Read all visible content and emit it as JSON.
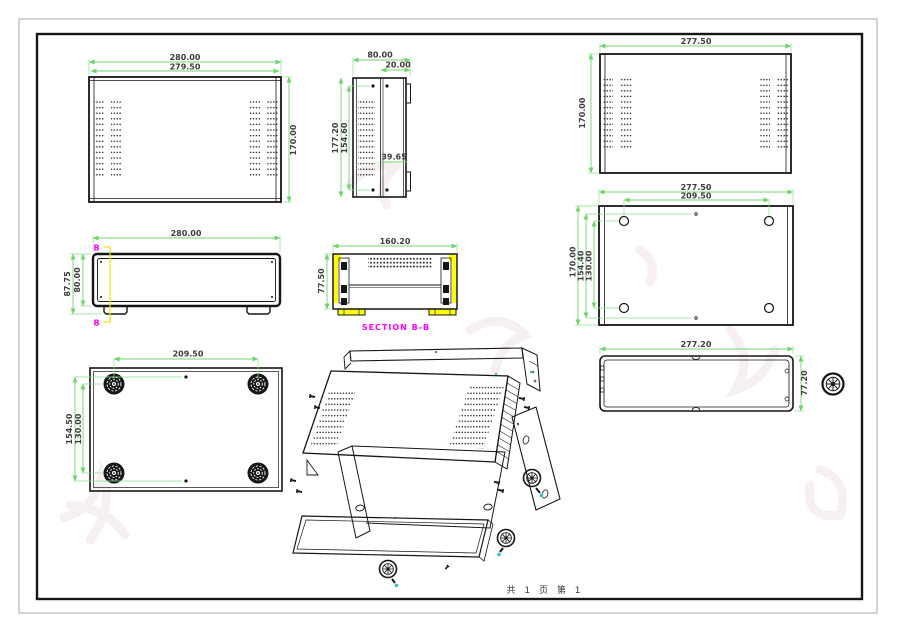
{
  "drawing": {
    "type": "sheet-metal enclosure engineering drawing",
    "footer": "共 1 页  第 1",
    "colors": {
      "outline": "#161616",
      "dimension_line": "#6fd66f",
      "dimension_text": "#3c3c3c",
      "section_label": "#ff00ff",
      "section_cut_fill": "#ffff00",
      "screw_tip": "#35c4c4"
    },
    "views": {
      "top_cover_front": {
        "dims": {
          "width_outer": "280.00",
          "width_inner": "279.50",
          "height": "170.00"
        }
      },
      "side_panel": {
        "dims": {
          "width": "80.00",
          "inset": "20.00",
          "height_outer": "177.20",
          "height_inner": "154.60",
          "mid": "39.65"
        }
      },
      "top_cover_rear": {
        "dims": {
          "width": "277.50",
          "height": "170.00"
        }
      },
      "front_panel": {
        "dims": {
          "width": "280.00",
          "height_outer": "87.75",
          "height_inner": "80.00"
        },
        "section_marker": "B"
      },
      "section_bb": {
        "dims": {
          "width": "160.20",
          "height": "77.50"
        },
        "label": "SECTION B-B"
      },
      "bottom_holes": {
        "dims": {
          "width_outer": "277.50",
          "width_inner": "209.50",
          "height_outer": "170.00",
          "height_mid": "154.40",
          "height_inner": "130.00"
        }
      },
      "bottom_feet": {
        "dims": {
          "width": "209.50",
          "height_outer": "154.50",
          "height_inner": "130.00"
        }
      },
      "rear_panel": {
        "dims": {
          "width": "277.20",
          "height": "77.20"
        }
      }
    }
  }
}
